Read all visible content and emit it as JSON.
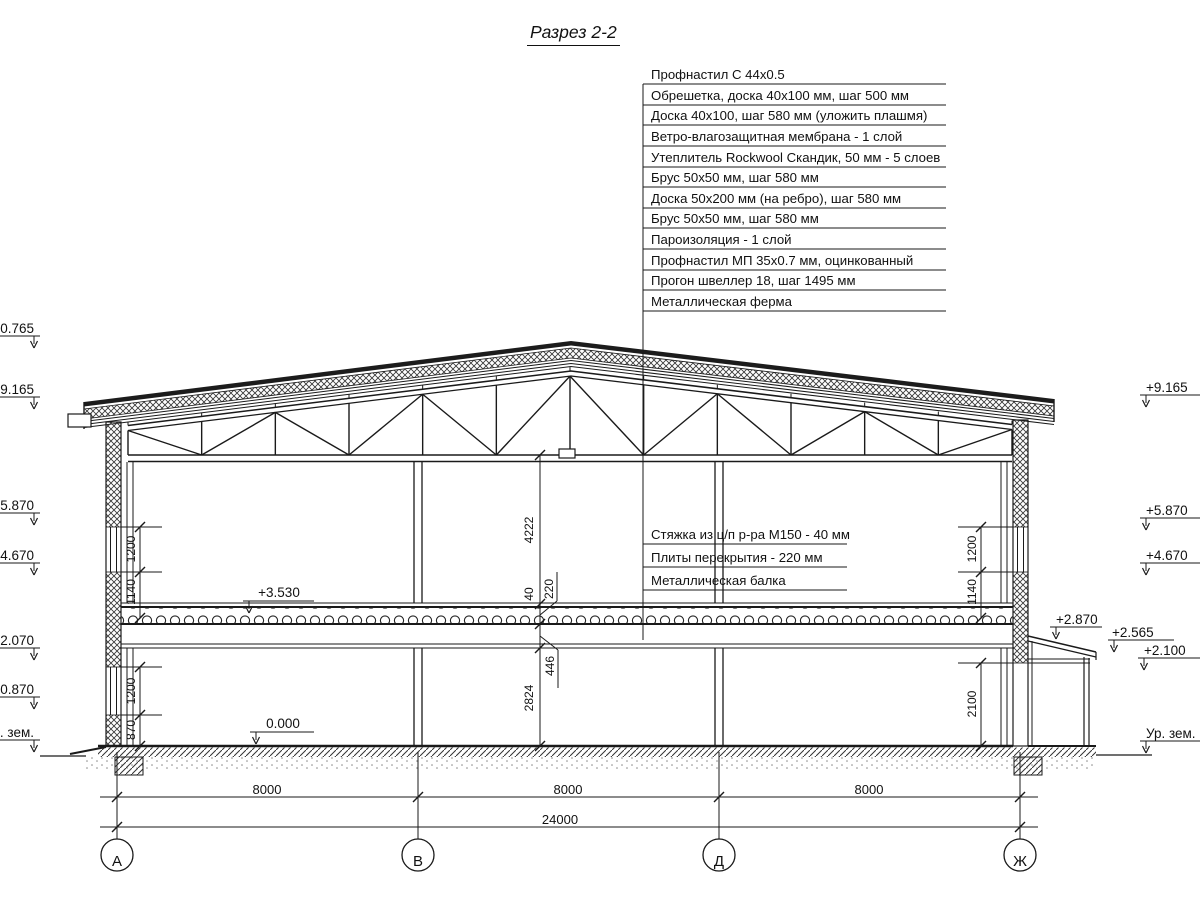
{
  "title": "Разрез 2-2",
  "roof_callouts": [
    "Профнастил С 44х0.5",
    "Обрешетка, доска 40х100 мм, шаг 500 мм",
    "Доска 40х100, шаг 580 мм (уложить плашмя)",
    "Ветро-влагозащитная мембрана - 1 слой",
    "Утеплитель Rockwool Скандик, 50 мм - 5 слоев",
    "Брус 50х50 мм, шаг 580 мм",
    "Доска 50х200 мм (на ребро), шаг 580 мм",
    "Брус 50х50 мм, шаг 580 мм",
    "Пароизоляция - 1 слой",
    "Профнастил МП 35х0.7 мм, оцинкованный",
    "Прогон швеллер 18, шаг 1495 мм",
    "Металлическая ферма"
  ],
  "floor_callouts": [
    "Стяжка из ц/п р-ра М150 - 40 мм",
    "Плиты перекрытия - 220 мм",
    "Металлическая балка"
  ],
  "elevations": {
    "left": [
      "+10.765",
      "+9.165",
      "+5.870",
      "+4.670",
      "+2.070",
      "+0.870",
      "Ур. зем."
    ],
    "right": [
      "+9.165",
      "+5.870",
      "+4.670",
      "+2.870",
      "+2.565",
      "+2.100",
      "Ур. зем."
    ],
    "interior": [
      "+3.530",
      "0.000"
    ]
  },
  "dims": {
    "left": [
      "1200",
      "1140",
      "1200",
      "870"
    ],
    "right": [
      "1200",
      "1140",
      "2100"
    ],
    "central": [
      "4222",
      "40",
      "220",
      "446",
      "2824"
    ],
    "spans": [
      "8000",
      "8000",
      "8000"
    ],
    "total": "24000"
  },
  "axes": [
    "А",
    "В",
    "Д",
    "Ж"
  ],
  "line_color": "#1a1a1a"
}
